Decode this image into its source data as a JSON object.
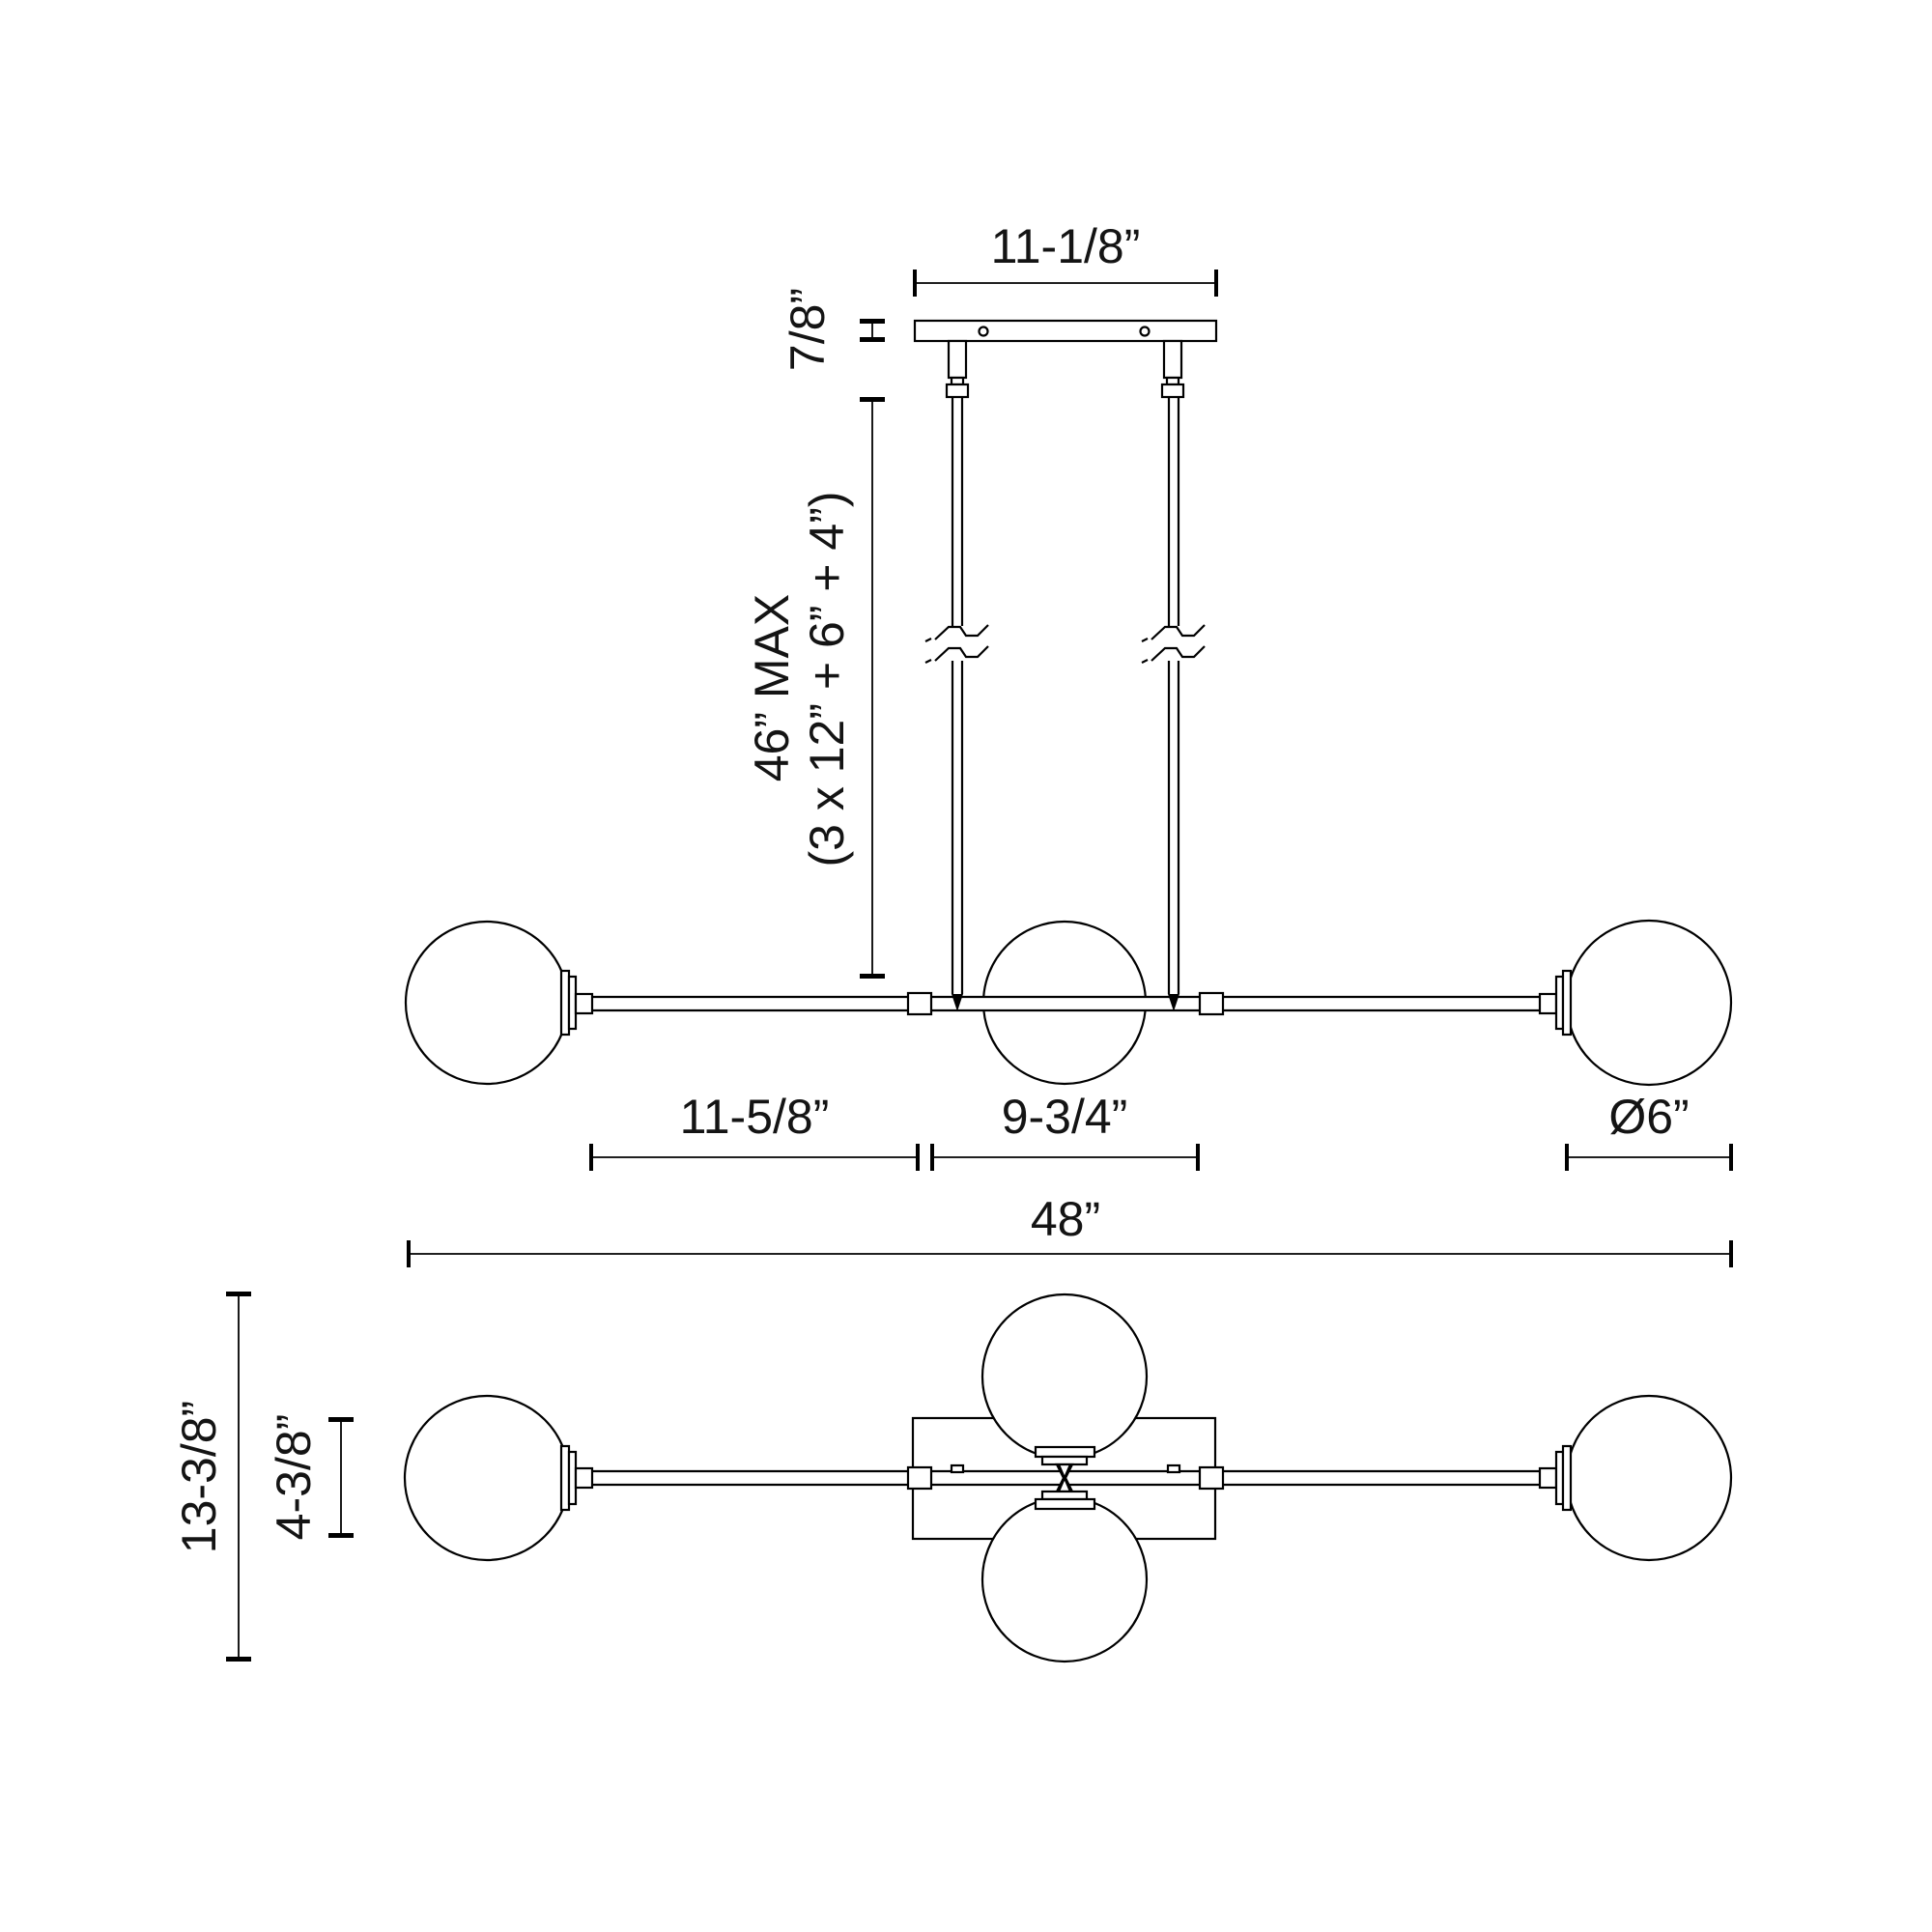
{
  "page": {
    "background_color": "#ffffff",
    "line_color": "#000000",
    "text_color": "#141414",
    "drawing_type": "linear chandelier dimension diagram"
  },
  "dimensions": {
    "canopy_width": "11-1/8”",
    "canopy_height": "7/8”",
    "suspension_max": "46” MAX",
    "suspension_breakdown": "(3 x 12” + 6” + 4”)",
    "left_arm_length": "11-5/8”",
    "center_section_length": "9-3/4”",
    "globe_diameter": "Ø6”",
    "overall_length": "48”",
    "overall_depth": "13-3/8”",
    "canopy_depth": "4-3/8”"
  }
}
